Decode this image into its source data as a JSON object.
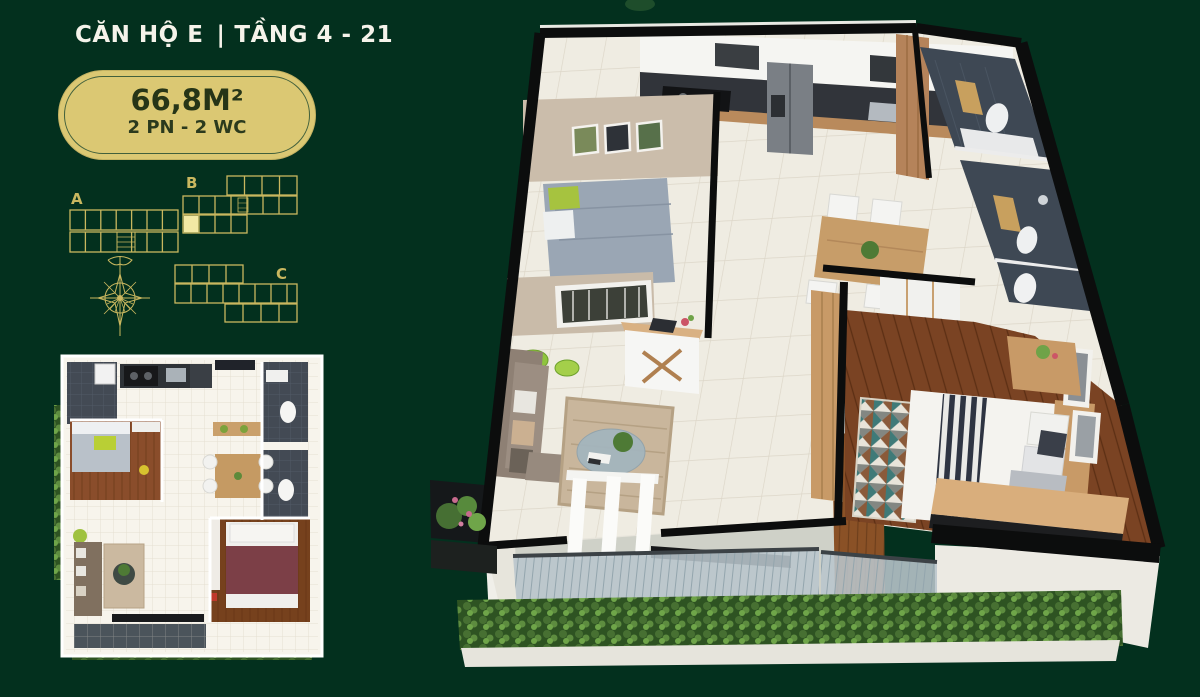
{
  "canvas": {
    "width": 1200,
    "height": 697,
    "background_color": "#03301e"
  },
  "header": {
    "apartment_name": "CĂN HỘ E",
    "separator": "|",
    "floor_range": "TẦNG 4 - 21",
    "text_color": "#f5f3ea"
  },
  "area_badge": {
    "area": "66,8M²",
    "configuration": "2 PN - 2 WC",
    "fill_color": "#dbc873",
    "inner_border_color": "#41603c",
    "text_color": "#263517"
  },
  "site_plan": {
    "stroke_color": "#c9b75f",
    "highlight_color": "#f2e9a4",
    "highlighted_block": "B",
    "blocks": [
      {
        "label": "A"
      },
      {
        "label": "B"
      },
      {
        "label": "C"
      }
    ]
  },
  "icons": {
    "compass": "compass-rose-icon"
  }
}
